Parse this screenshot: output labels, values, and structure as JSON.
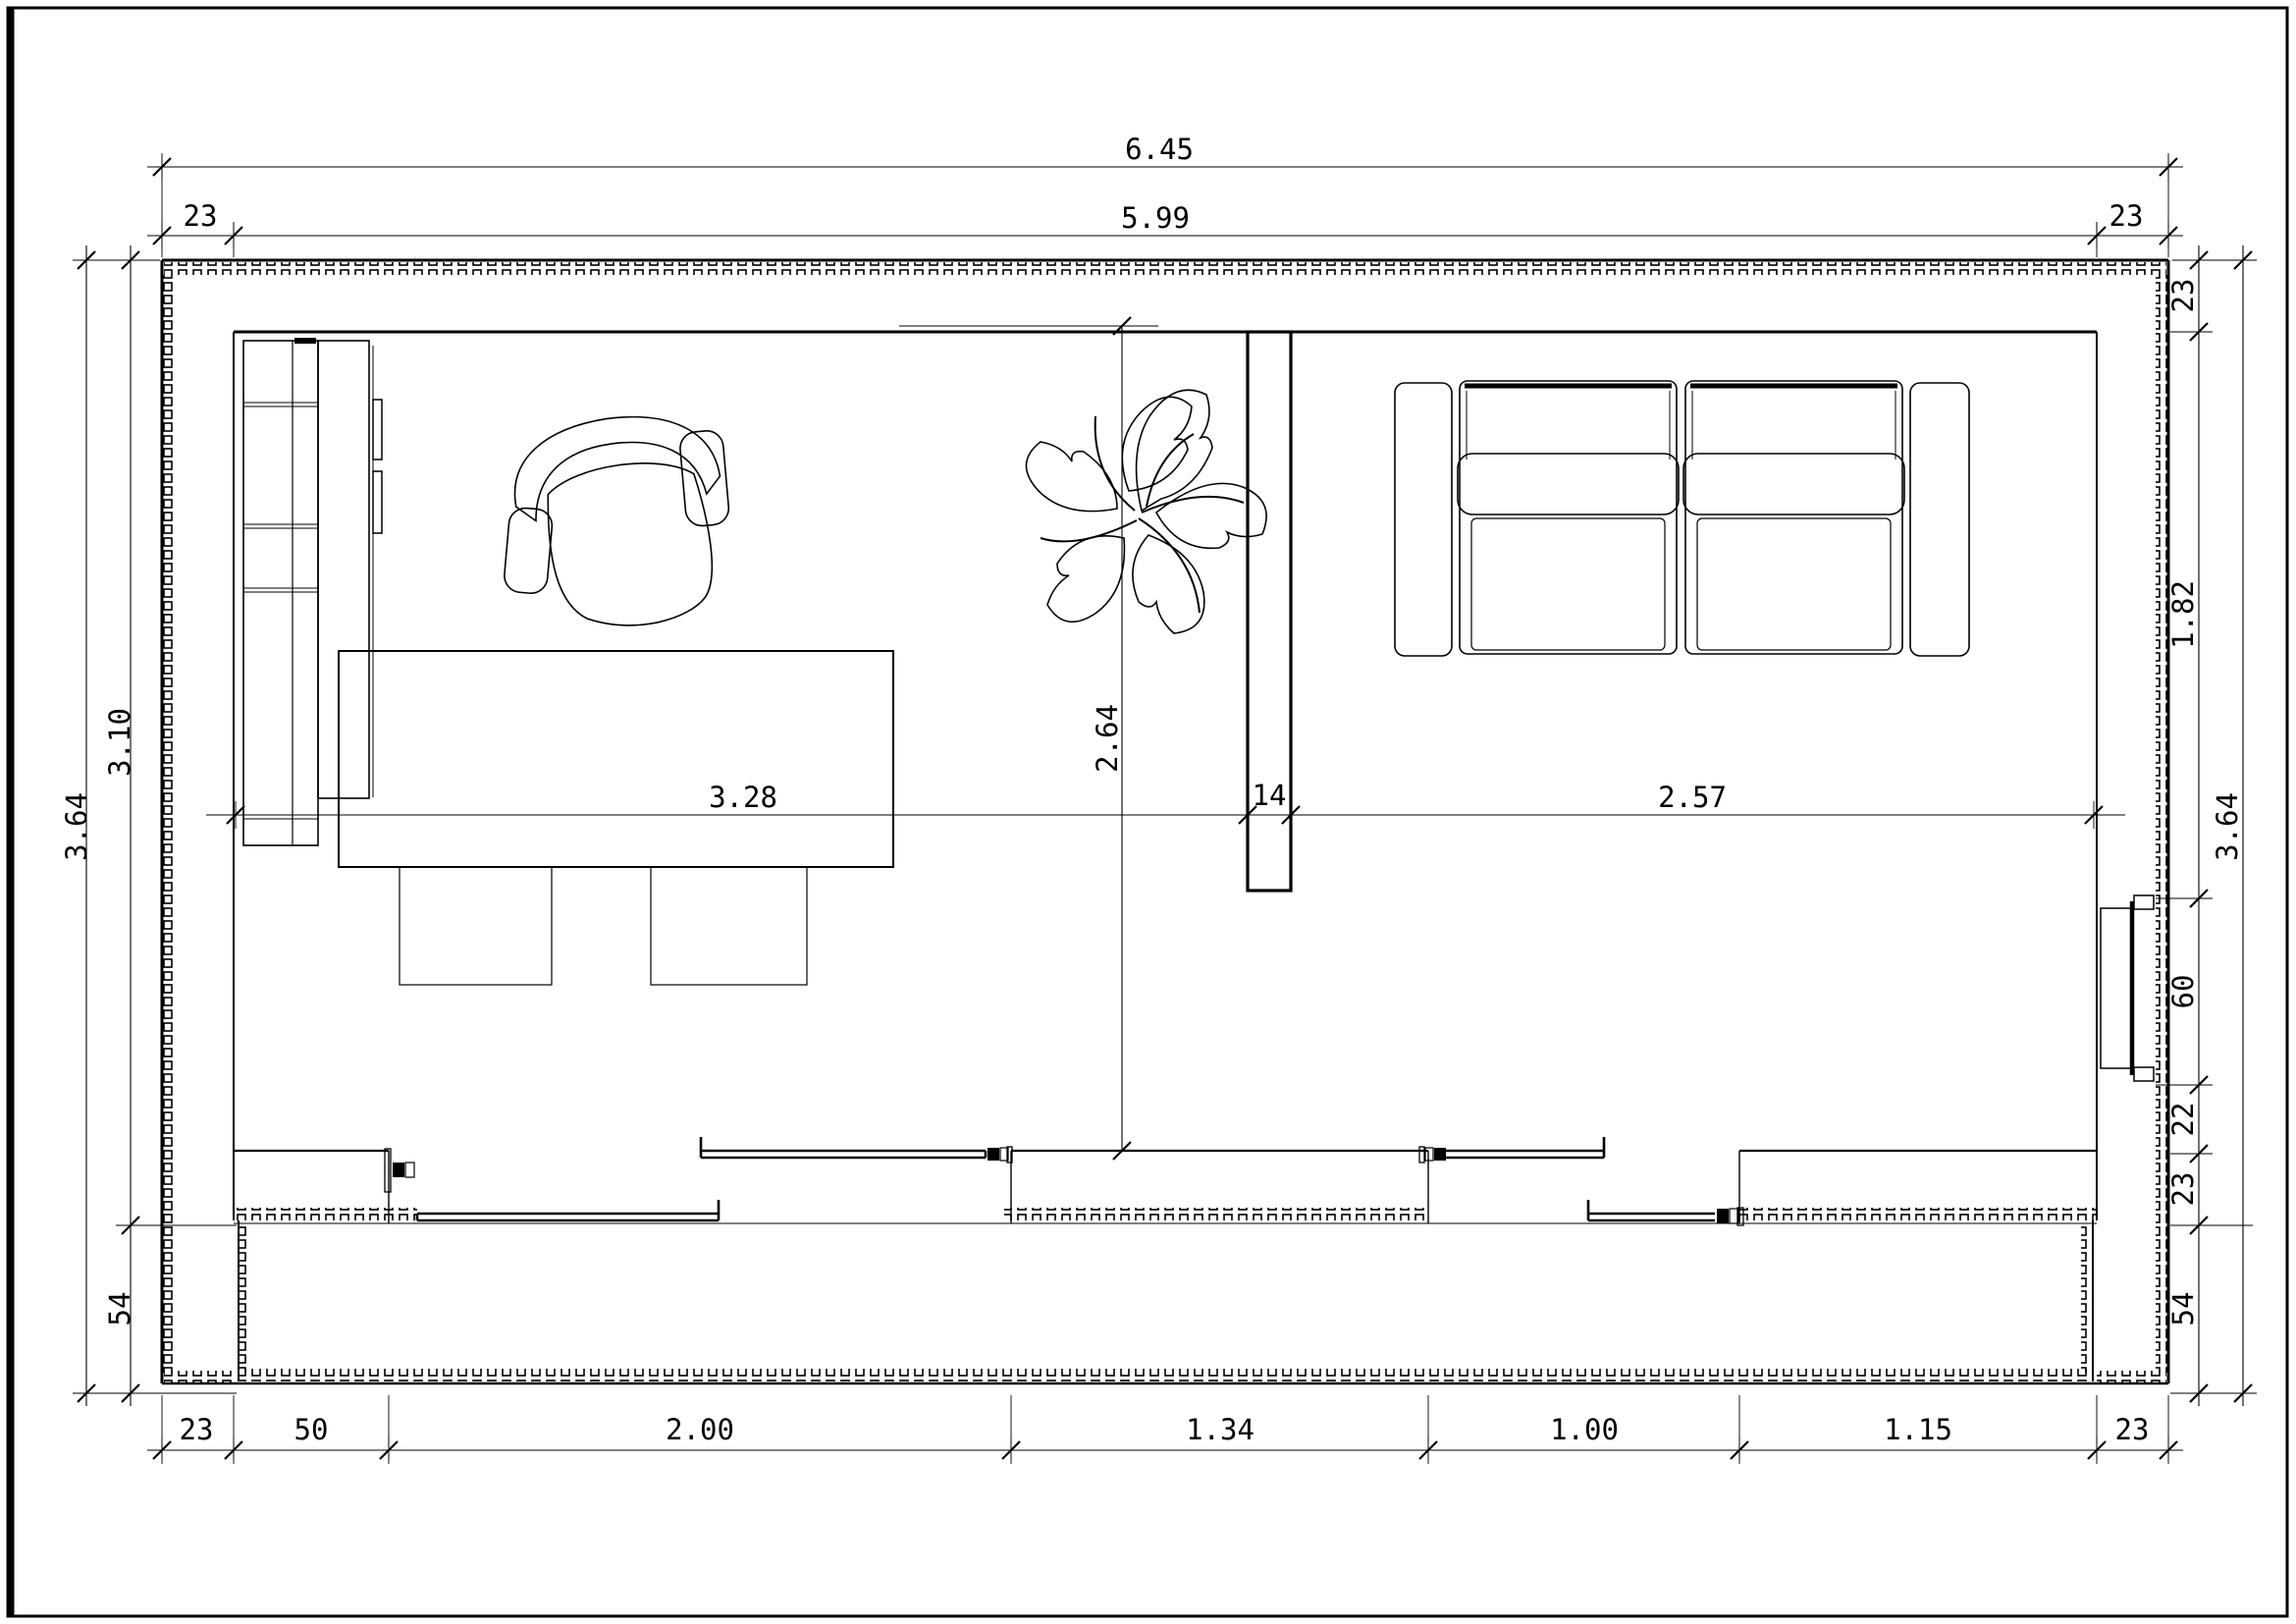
{
  "drawing": {
    "kind": "architectural floor plan, top view, single room with porch",
    "line_color": "#000000",
    "background": "#ffffff"
  },
  "dims": {
    "top": {
      "total": "6.45",
      "inner": "5.99",
      "left_wall": "23",
      "right_wall": "23"
    },
    "bottom": {
      "left_wall": "23",
      "pier": "50",
      "window_large": "2.00",
      "between_windows": "1.34",
      "window_small": "1.00",
      "pier_right": "1.15",
      "right_wall": "23"
    },
    "left": {
      "total": "3.64",
      "room": "3.10",
      "porch": "54"
    },
    "right": {
      "wall_top": "23",
      "upper": "1.82",
      "window": "60",
      "below_window": "22",
      "wall_bottom": "23",
      "porch": "54",
      "total": "3.64"
    },
    "interior": {
      "left_zone": "3.28",
      "partition": "14",
      "right_zone": "2.57",
      "depth": "2.64"
    }
  }
}
